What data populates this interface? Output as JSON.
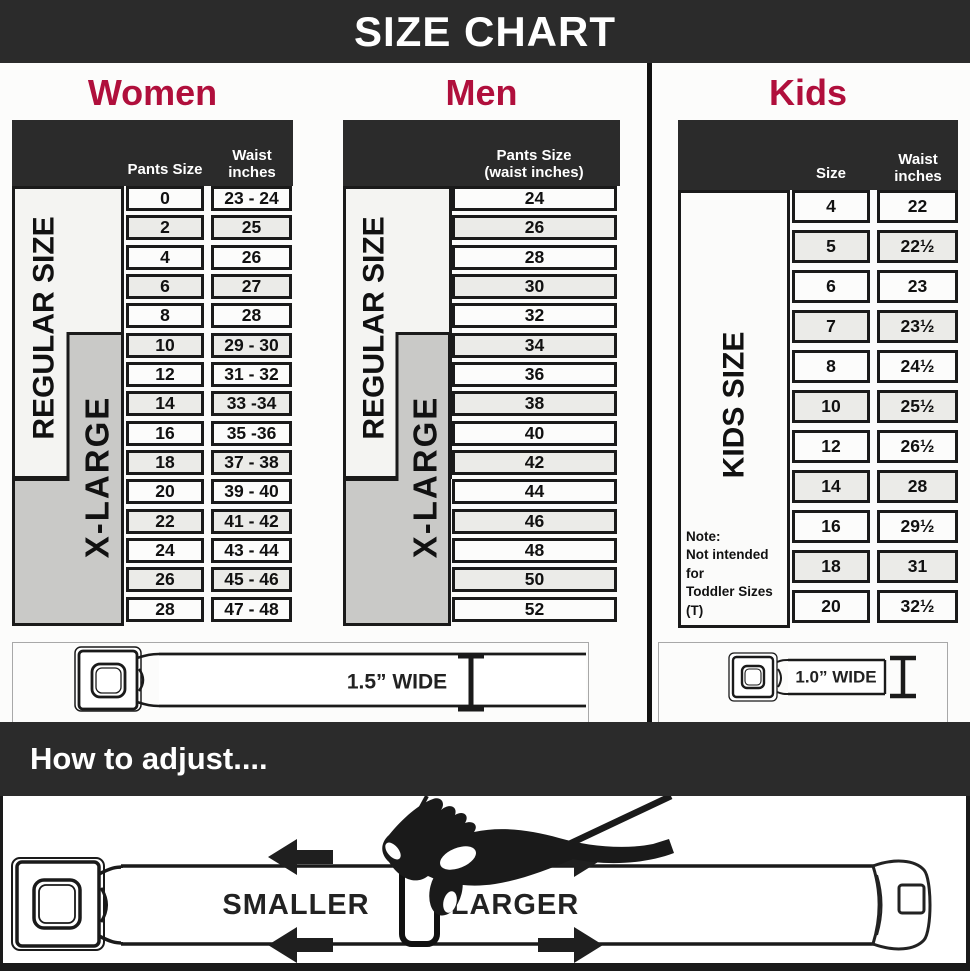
{
  "banner": {
    "title": "SIZE CHART"
  },
  "colors": {
    "accent": "#b00f3c",
    "header_bg": "#2b2b2b",
    "band_gray": "#c9c9c7",
    "band_white": "#f4f4f2",
    "ink": "#1a1a1a"
  },
  "chart_data": [
    {
      "type": "table",
      "section": "Women",
      "columns": [
        "Pants Size",
        "Waist inches"
      ],
      "side_bands": {
        "regular": "REGULAR SIZE",
        "xlarge": "X-LARGE"
      },
      "regular_band_rows": [
        0,
        9
      ],
      "xlarge_band_rows": [
        5,
        14
      ],
      "rows": [
        [
          "0",
          "23 - 24"
        ],
        [
          "2",
          "25"
        ],
        [
          "4",
          "26"
        ],
        [
          "6",
          "27"
        ],
        [
          "8",
          "28"
        ],
        [
          "10",
          "29 - 30"
        ],
        [
          "12",
          "31 - 32"
        ],
        [
          "14",
          "33 -34"
        ],
        [
          "16",
          "35 -36"
        ],
        [
          "18",
          "37 - 38"
        ],
        [
          "20",
          "39 - 40"
        ],
        [
          "22",
          "41 - 42"
        ],
        [
          "24",
          "43 - 44"
        ],
        [
          "26",
          "45 - 46"
        ],
        [
          "28",
          "47 - 48"
        ]
      ]
    },
    {
      "type": "table",
      "section": "Men",
      "columns": [
        "Pants Size (waist inches)"
      ],
      "side_bands": {
        "regular": "REGULAR SIZE",
        "xlarge": "X-LARGE"
      },
      "regular_band_rows": [
        0,
        9
      ],
      "xlarge_band_rows": [
        5,
        14
      ],
      "rows": [
        "24",
        "26",
        "28",
        "30",
        "32",
        "34",
        "36",
        "38",
        "40",
        "42",
        "44",
        "46",
        "48",
        "50",
        "52"
      ]
    },
    {
      "type": "table",
      "section": "Kids",
      "columns": [
        "Size",
        "Waist inches"
      ],
      "side_label": "KIDS SIZE",
      "note_lines": [
        "Note:",
        "Not intended for",
        "Toddler Sizes (T)"
      ],
      "rows": [
        [
          "4",
          "22"
        ],
        [
          "5",
          "22½"
        ],
        [
          "6",
          "23"
        ],
        [
          "7",
          "23½"
        ],
        [
          "8",
          "24½"
        ],
        [
          "10",
          "25½"
        ],
        [
          "12",
          "26½"
        ],
        [
          "14",
          "28"
        ],
        [
          "16",
          "29½"
        ],
        [
          "18",
          "31"
        ],
        [
          "20",
          "32½"
        ]
      ]
    }
  ],
  "belts": {
    "adult_label": "1.5” WIDE",
    "kids_label": "1.0” WIDE"
  },
  "adjust": {
    "title": "How to adjust....",
    "smaller": "SMALLER",
    "larger": "LARGER"
  }
}
